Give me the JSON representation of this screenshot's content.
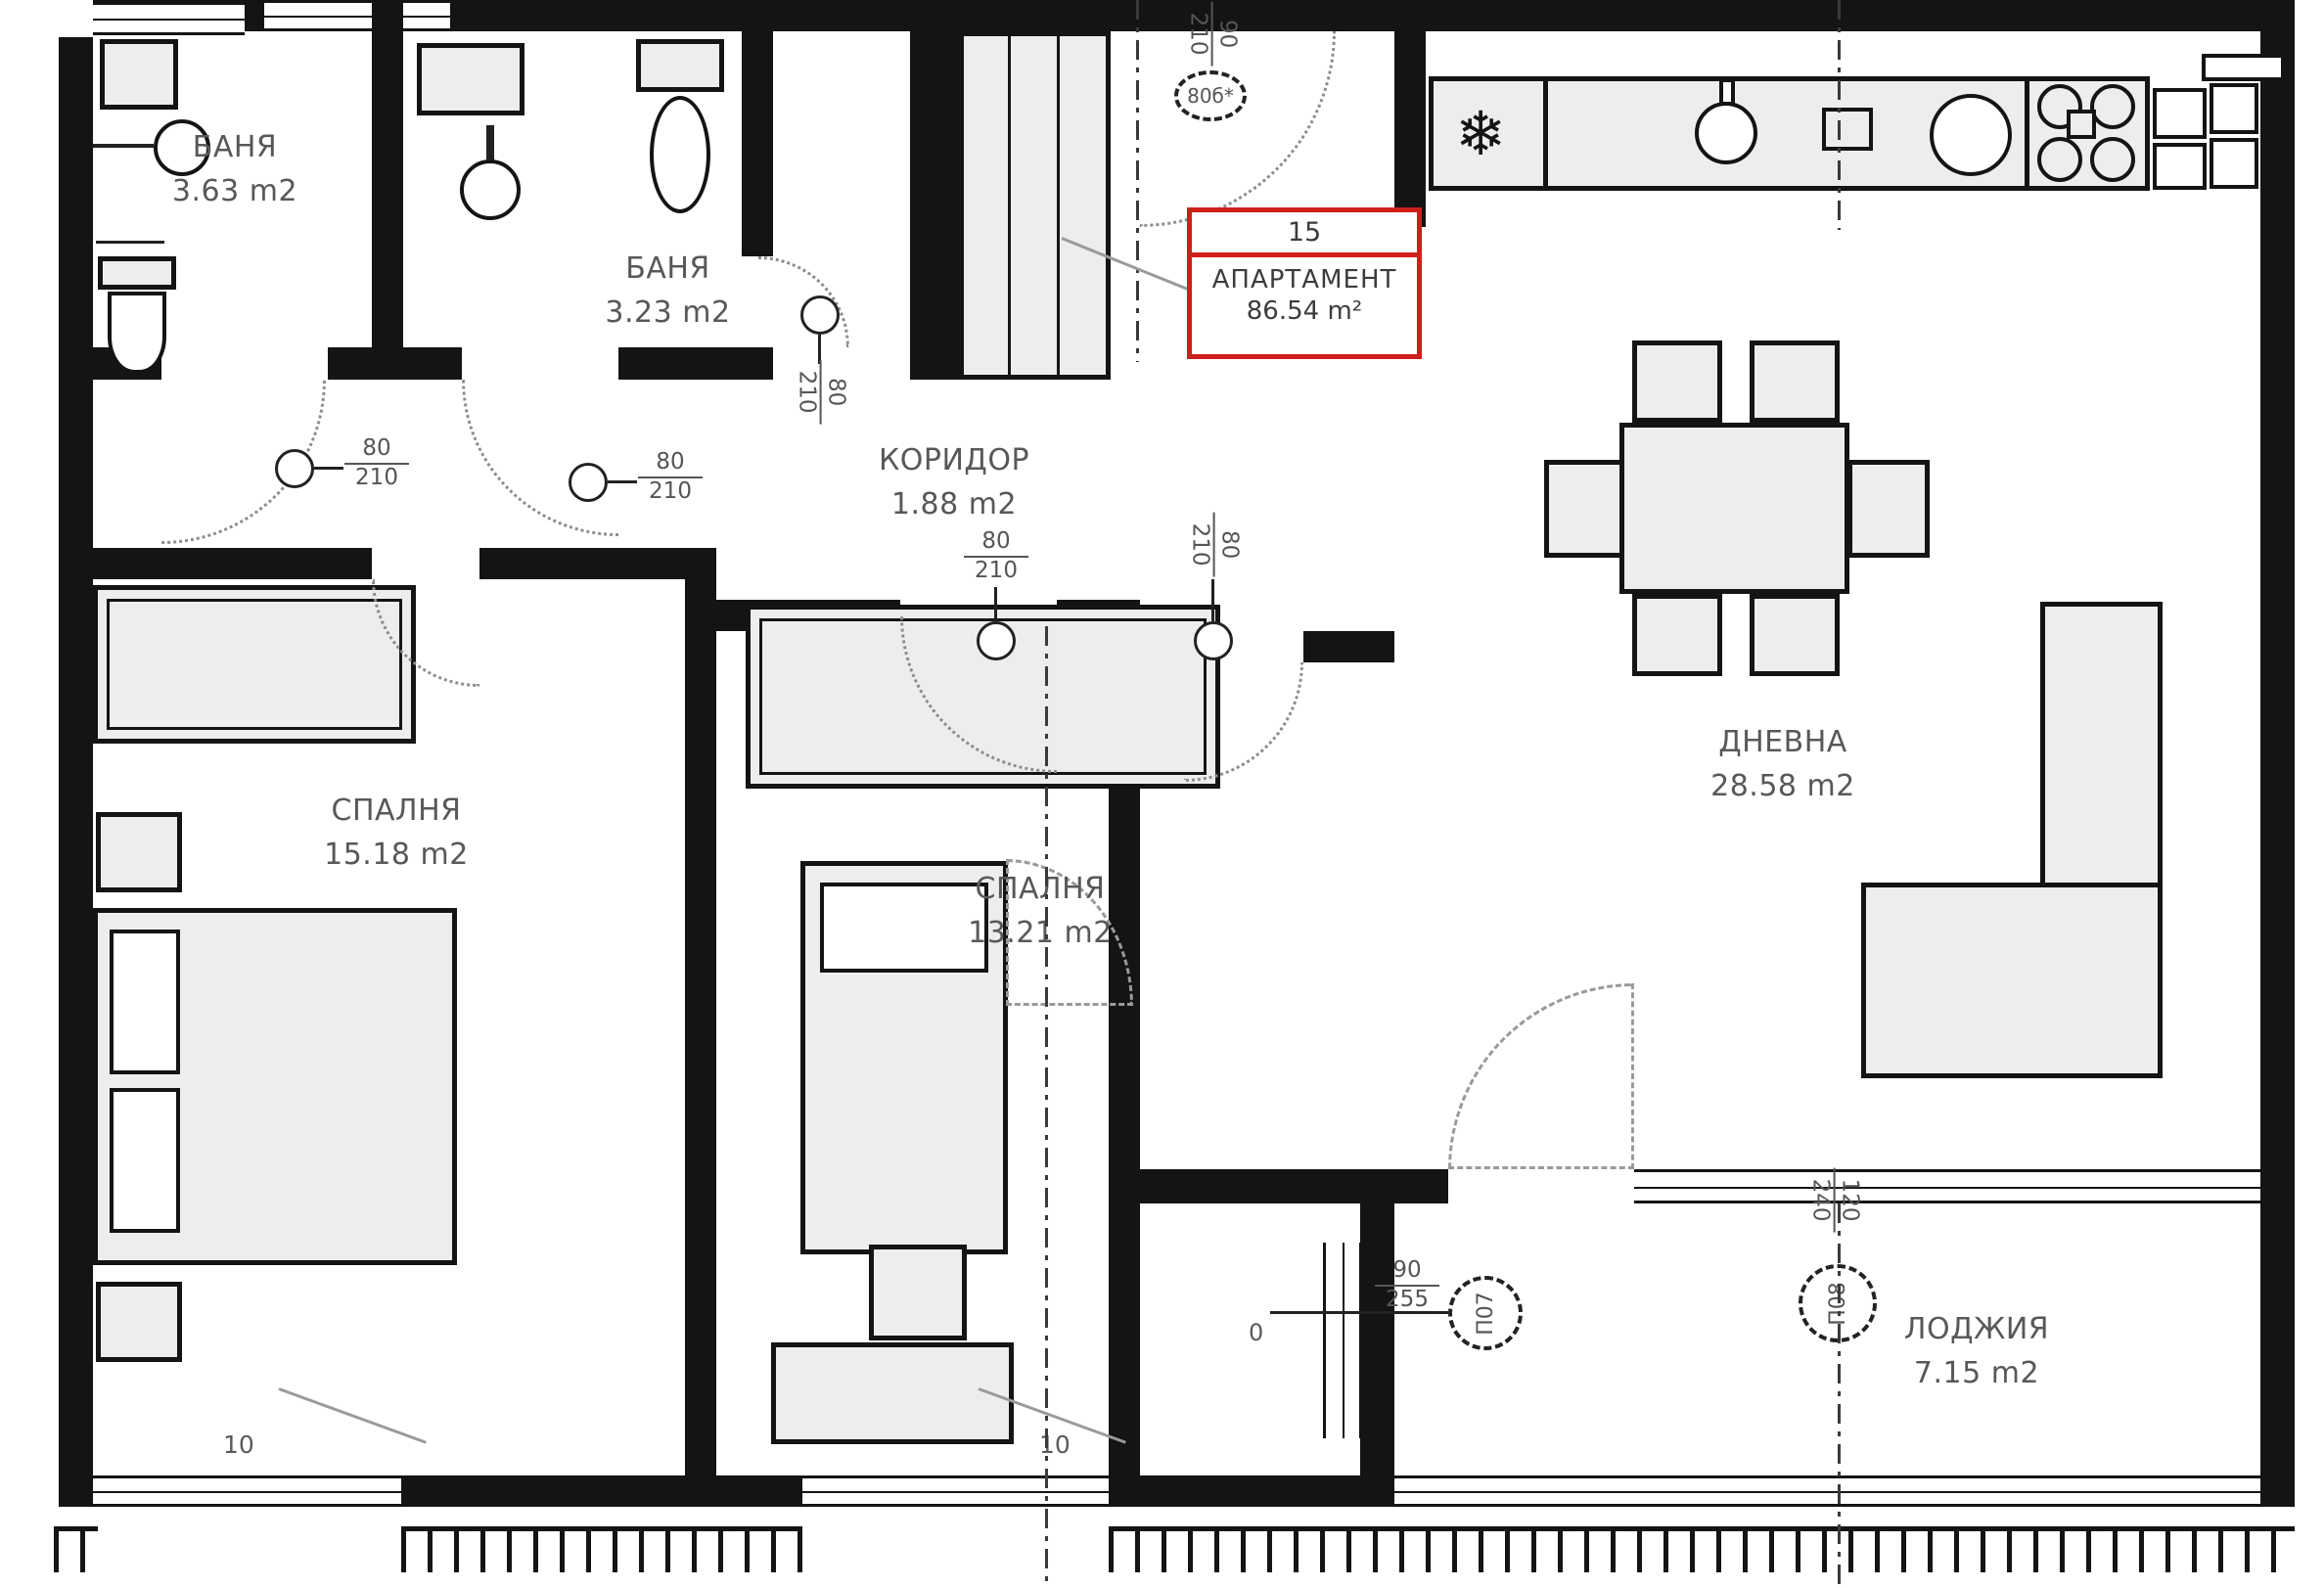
{
  "plan": {
    "unit_box": {
      "number": "15",
      "label": "АПАРТАМЕНТ",
      "area": "86.54 m²"
    },
    "rooms": {
      "bath1": {
        "name": "БАНЯ",
        "area": "3.63 m2"
      },
      "bath2": {
        "name": "БАНЯ",
        "area": "3.23 m2"
      },
      "corridor": {
        "name": "КОРИДОР",
        "area": "1.88 m2"
      },
      "bedroom1": {
        "name": "СПАЛНЯ",
        "area": "15.18 m2"
      },
      "bedroom2": {
        "name": "СПАЛНЯ",
        "area": "13.21 m2"
      },
      "living": {
        "name": "ДНЕВНА",
        "area": "28.58 m2"
      },
      "loggia": {
        "name": "ЛОДЖИЯ",
        "area": "7.15 m2"
      }
    },
    "doors": {
      "bath1": {
        "w": "80",
        "h": "210"
      },
      "bath2": {
        "w": "80",
        "h": "210"
      },
      "vestibule": {
        "w": "80",
        "h": "210"
      },
      "bedroom2": {
        "w": "80",
        "h": "210"
      },
      "living": {
        "w": "80",
        "h": "210"
      },
      "entrance": {
        "tag": "80б*",
        "w": "90",
        "h": "210"
      }
    },
    "portals": {
      "p07": {
        "label": "П07",
        "w": "90",
        "h": "255"
      },
      "p08": {
        "label": "П08",
        "w": "120",
        "h": "240"
      }
    },
    "marks": {
      "sill_left": "10",
      "sill_mid": "10",
      "zero": "0"
    },
    "icons": {
      "fridge": "❄"
    },
    "colors": {
      "wall": "#141414",
      "accent_red": "#d01f1a",
      "furniture": "#ededed"
    }
  }
}
